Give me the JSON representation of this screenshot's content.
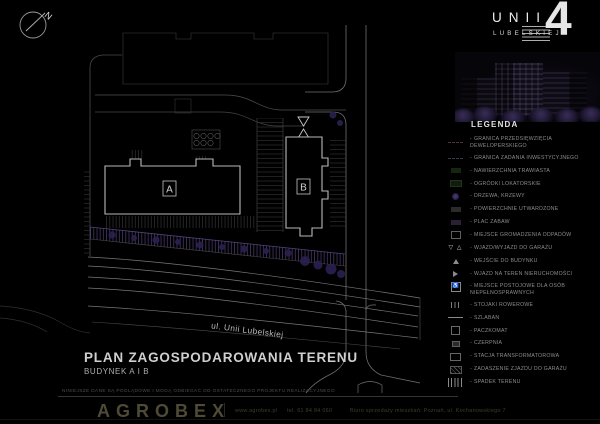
{
  "logo": {
    "line1": "UNII",
    "line2": "LUBELSKIEJ",
    "numeral": "4"
  },
  "plan": {
    "compass_label": "N",
    "building_a_label": "A",
    "building_b_label": "B",
    "street_label": "ul. Unii Lubelskiej"
  },
  "legend": {
    "title": "LEGENDA",
    "bullet": "-",
    "items": [
      {
        "label": "GRANICA PRZEDSIĘWZIĘCIA DEWELOPERSKIEGO",
        "symbol": "boundary-developer"
      },
      {
        "label": "GRANICA ZADANIA INWESTYCYJNEGO",
        "symbol": "boundary-investment"
      },
      {
        "label": "NAWIERZCHNIA TRAWIASTA",
        "symbol": "grass-surface"
      },
      {
        "label": "OGRÓDKI LOKATORSKIE",
        "symbol": "tenant-gardens"
      },
      {
        "label": "DRZEWA, KRZEWY",
        "symbol": "trees-shrubs"
      },
      {
        "label": "POWIERZCHNIE UTWARDZONE",
        "symbol": "paved-surface"
      },
      {
        "label": "PLAC ZABAW",
        "symbol": "playground"
      },
      {
        "label": "MIEJSCE GROMADZENIA ODPADÓW",
        "symbol": "waste-collection"
      },
      {
        "label": "WJAZD/WYJAZD DO GARAŻU",
        "symbol": "garage-entry-exit",
        "glyph": "▽ △"
      },
      {
        "label": "WEJŚCIE DO BUDYNKU",
        "symbol": "building-entrance"
      },
      {
        "label": "WJAZD NA TEREN NIERUCHOMOŚCI",
        "symbol": "property-entry"
      },
      {
        "label": "MIEJSCE POSTOJOWE DLA OSÓB NIEPEŁNOSPRAWNYCH",
        "symbol": "disabled-parking",
        "glyph": "♿"
      },
      {
        "label": "STOJAKI ROWEROWE",
        "symbol": "bike-racks"
      },
      {
        "label": "SZLABAN",
        "symbol": "barrier"
      },
      {
        "label": "PACZKOMAT",
        "symbol": "parcel-locker"
      },
      {
        "label": "CZERPNIA",
        "symbol": "air-intake"
      },
      {
        "label": "STACJA TRANSFORMATOROWA",
        "symbol": "transformer-station"
      },
      {
        "label": "ZADASZENIE ZJAZDU DO GARAŻU",
        "symbol": "garage-ramp-roof"
      },
      {
        "label": "SPADEK TERENU",
        "symbol": "terrain-slope"
      }
    ]
  },
  "title_block": {
    "title": "PLAN ZAGOSPODAROWANIA TERENU",
    "subtitle": "BUDYNEK A I B",
    "disclaimer": "NINIEJSZE DANE SĄ POGLĄDOWE I MOGĄ ODBIEGAĆ OD OSTATECZNEGO PROJEKTU REALIZACYJNEGO"
  },
  "footer": {
    "brand": "AGROBEX",
    "website": "www.agrobex.pl",
    "phone": "tel. 61 84 84 060",
    "sales_office": "Biuro sprzedaży mieszkań: Poznań, ul. Kochanowskiego 7"
  },
  "colors": {
    "background": "#000000",
    "plan_line": "#b9b9b9",
    "plan_line_faint": "#2c2c2c",
    "accent_purple": "#4c3e72",
    "legend_text": "#8c8c8c",
    "brand_olive": "#4e4a35"
  }
}
